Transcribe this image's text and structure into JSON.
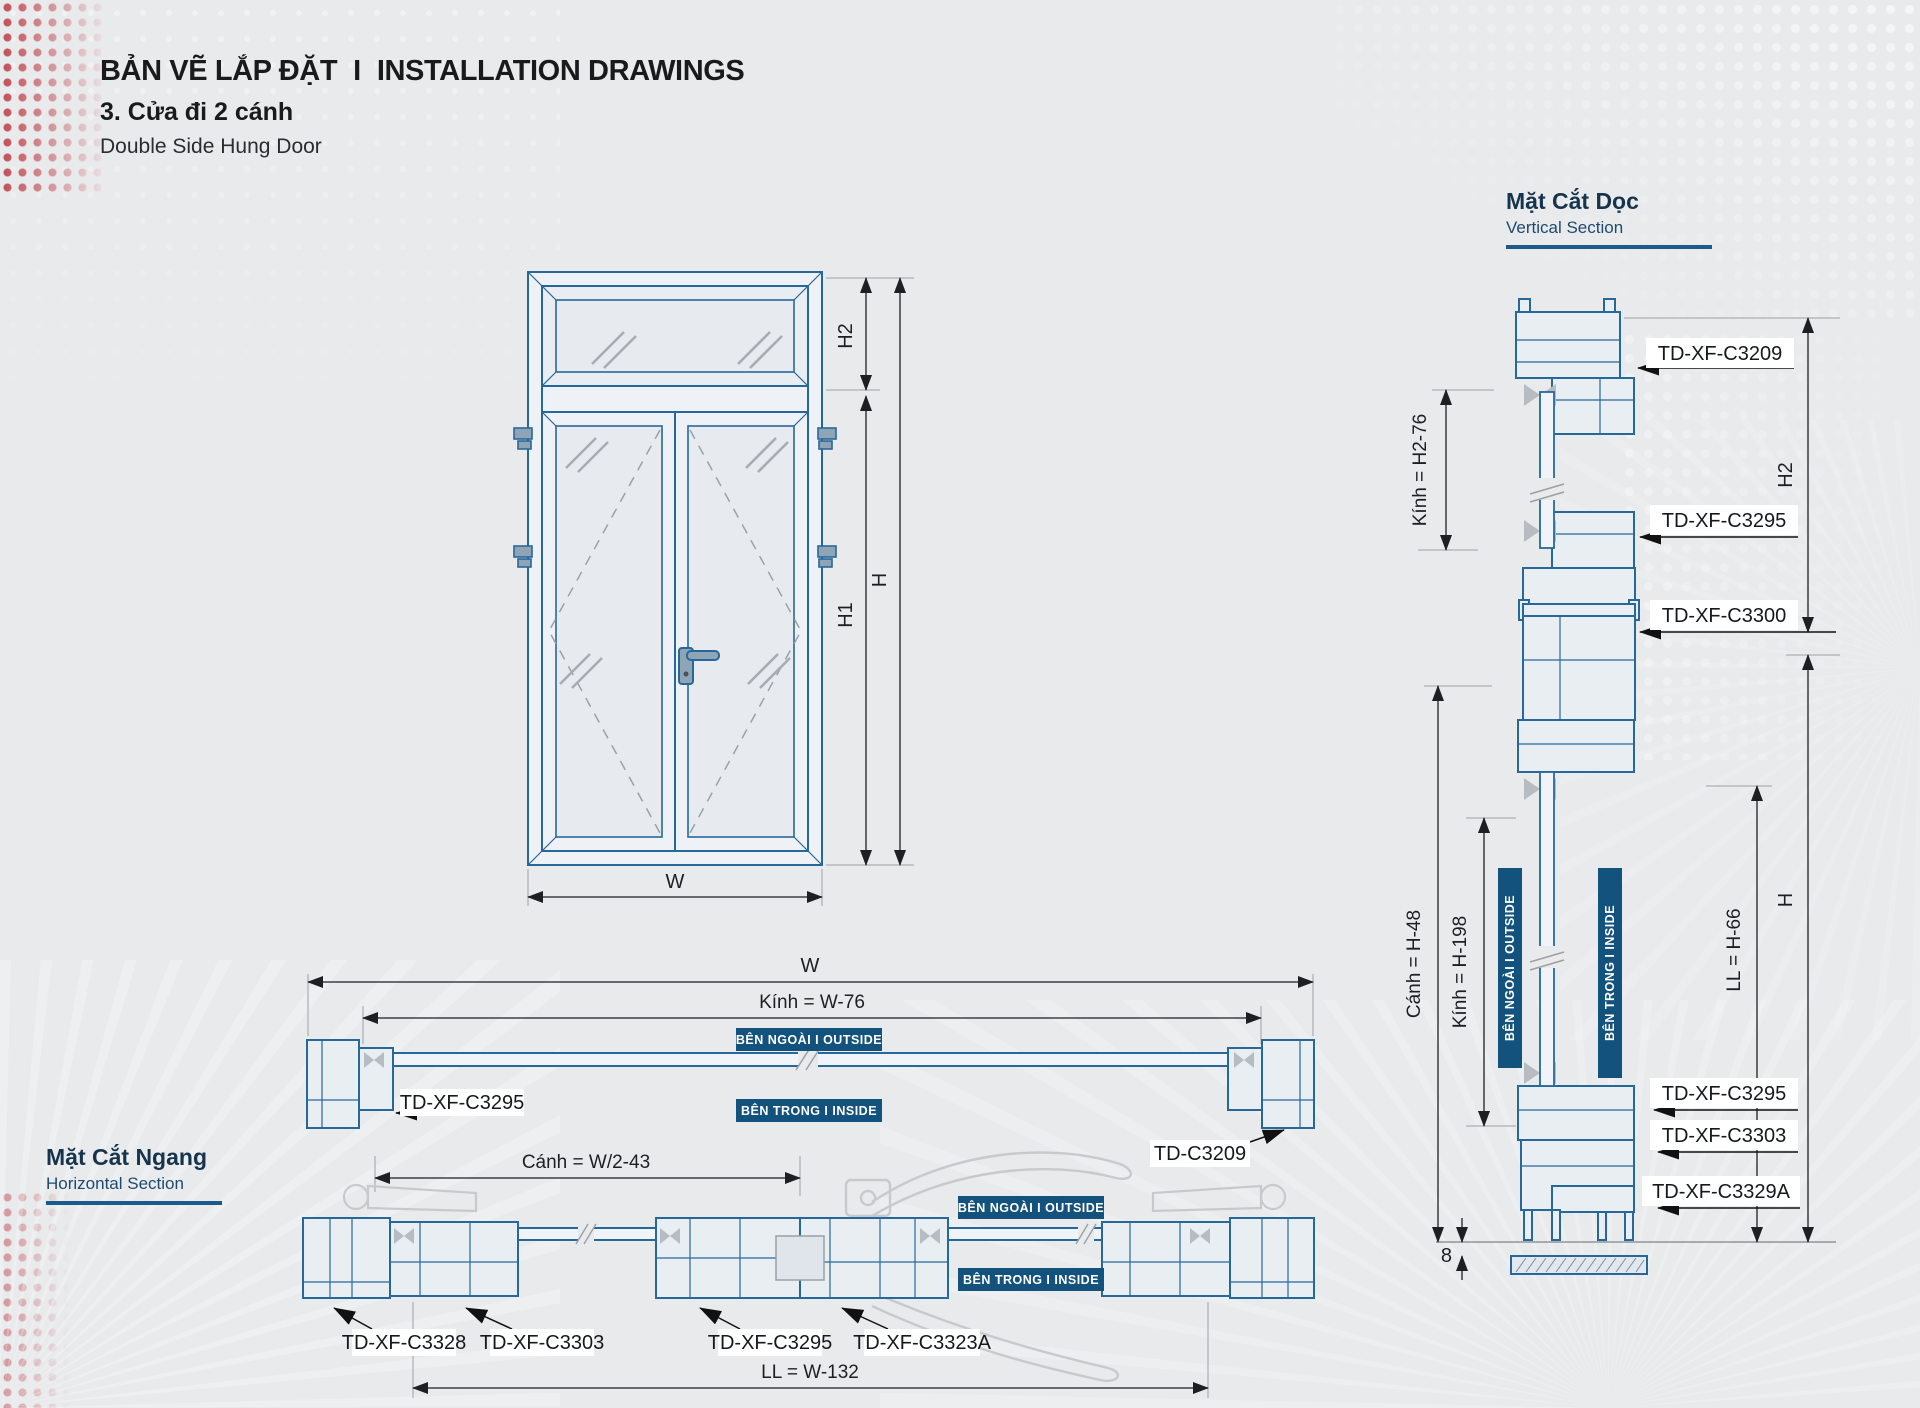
{
  "header": {
    "title_vi": "BẢN VẼ LẮP ĐẶT",
    "separator": "I",
    "title_en": "INSTALLATION DRAWINGS",
    "subtitle_vi": "3. Cửa đi 2 cánh",
    "subtitle_en": "Double Side Hung Door"
  },
  "vertical_section": {
    "heading_vi": "Mặt Cắt Dọc",
    "heading_en": "Vertical Section",
    "labels": {
      "c3209": "TD-XF-C3209",
      "c3295_top": "TD-XF-C3295",
      "c3300": "TD-XF-C3300",
      "c3295_bottom": "TD-XF-C3295",
      "c3303": "TD-XF-C3303",
      "c3329a": "TD-XF-C3329A"
    },
    "dims": {
      "kinh_top": "Kính = H2-76",
      "h2": "H2",
      "canh": "Cánh = H-48",
      "kinh_bottom": "Kính = H-198",
      "ll": "LL = H-66",
      "h": "H",
      "floor_gap": "8"
    },
    "badges": {
      "outside": "BÊN NGOÀI  I  OUTSIDE",
      "inside": "BÊN TRONG  I  INSIDE"
    }
  },
  "elevation": {
    "dims": {
      "h2": "H2",
      "h1": "H1",
      "h": "H",
      "w": "W"
    }
  },
  "horizontal_section": {
    "heading_vi": "Mặt Cắt Ngang",
    "heading_en": "Horizontal Section",
    "dims": {
      "w": "W",
      "kinh": "Kính = W-76",
      "canh": "Cánh = W/2-43",
      "ll": "LL = W-132"
    },
    "labels": {
      "c3295_frame": "TD-XF-C3295",
      "c3209": "TD-C3209",
      "c3328": "TD-XF-C3328",
      "c3303": "TD-XF-C3303",
      "c3295_leaf": "TD-XF-C3295",
      "c3323a": "TD-XF-C3323A"
    },
    "badges": {
      "outside_top": "BÊN NGOÀI  I  OUTSIDE",
      "inside_top": "BÊN TRONG  I  INSIDE",
      "outside_bottom": "BÊN NGOÀI  I  OUTSIDE",
      "inside_bottom": "BÊN TRONG  I  INSIDE"
    }
  },
  "colors": {
    "accent_navy": "#14527e",
    "drawing_blue": "#27689a",
    "accent_red": "#b82932",
    "label_bg": "#ffffff",
    "dim_text": "#1d1f22"
  }
}
